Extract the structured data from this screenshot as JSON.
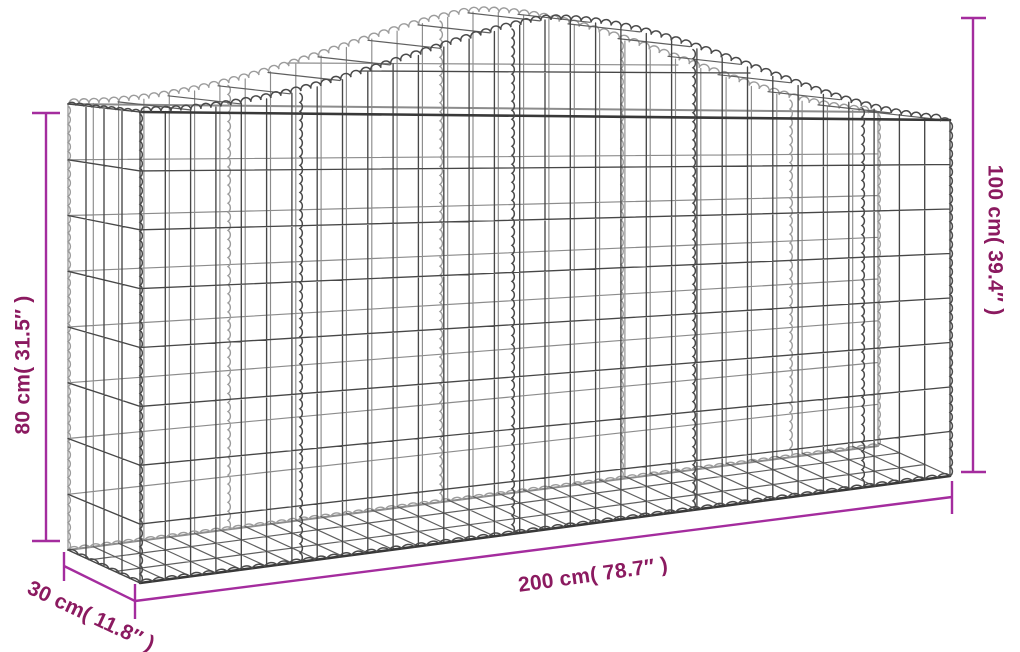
{
  "image": {
    "type": "product-dimension-diagram",
    "subject": "Arched gabion wire mesh basket, galvanized iron wireframe drawing"
  },
  "dimensions": {
    "height_left": {
      "label": "80 cm( 31.5″ )"
    },
    "height_right": {
      "label": "100 cm( 39.4″ )"
    },
    "length": {
      "label": "200 cm( 78.7″ )"
    },
    "depth": {
      "label": "30 cm( 11.8″ )"
    }
  },
  "colors": {
    "background": "#ffffff",
    "dimension_line": "#a42c9e",
    "dimension_text": "#8b1a60",
    "wire": "#474747",
    "wire_frame": "#383838",
    "wire_light": "#8c8c8c",
    "wire_mid": "#5f5f5f",
    "coil": "#4a4a4a",
    "coil_light": "#9c9c9c"
  }
}
